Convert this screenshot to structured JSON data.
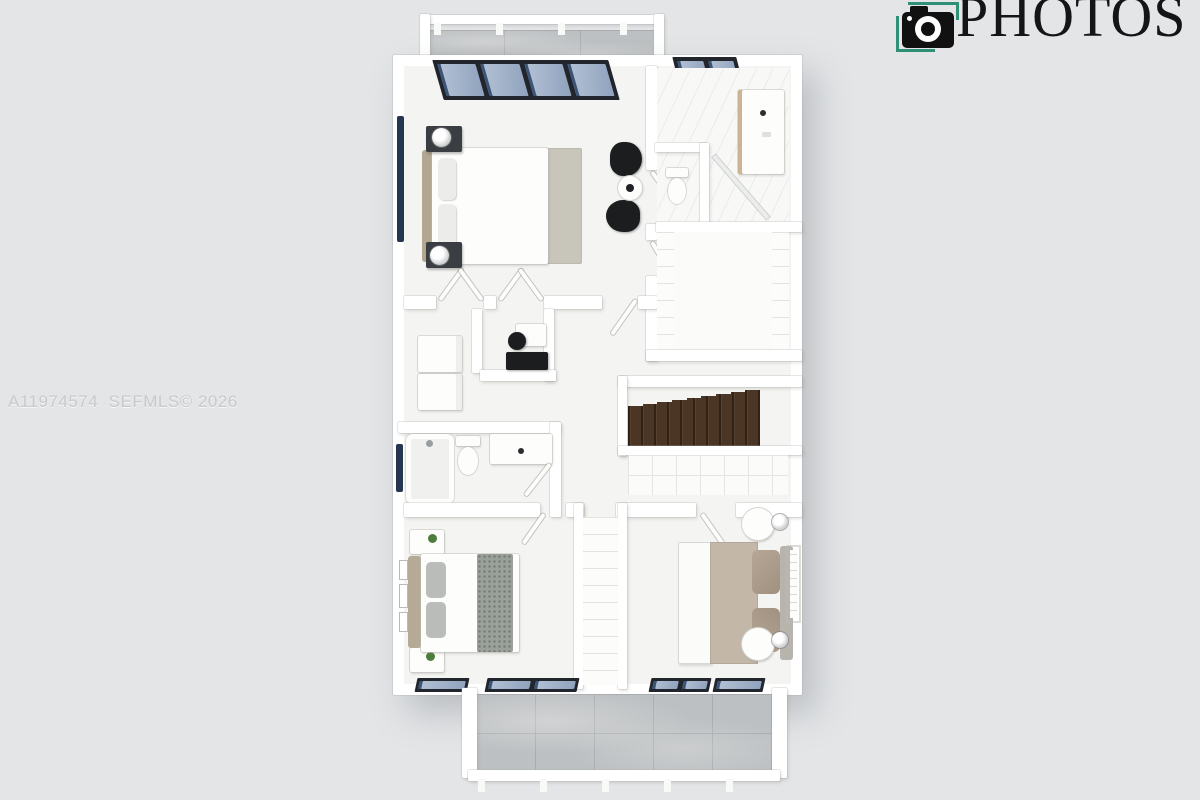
{
  "watermark": {
    "listing_id": "A11974574",
    "mls_text": "SEFMLS© 2026",
    "text_color": "#c7c9cb"
  },
  "brand": {
    "name": "PHOTOS",
    "icon": "camera-icon",
    "accent_color": "#2f9077",
    "text_color": "#151515"
  },
  "palette": {
    "background": "#e3e5e7",
    "walls": "#ffffff",
    "floor": "#f4f4f2",
    "balcony_tile": "#bdc0c2",
    "window_glass": "#a3b3ca",
    "window_frame": "#22262c",
    "stairs_wood": "#4b3625",
    "bedding_beige": "#c3b7a7",
    "rug_gray": "#c8c5ba"
  },
  "scene": {
    "type": "3d-floor-plan-render",
    "rooms": [
      "balcony-top",
      "primary-bedroom",
      "primary-bathroom",
      "walk-in-closet",
      "laundry",
      "desk-nook",
      "hallway",
      "stairs",
      "bathroom-2",
      "bedroom-2",
      "linen-closet",
      "bedroom-3",
      "balcony-bottom"
    ]
  }
}
